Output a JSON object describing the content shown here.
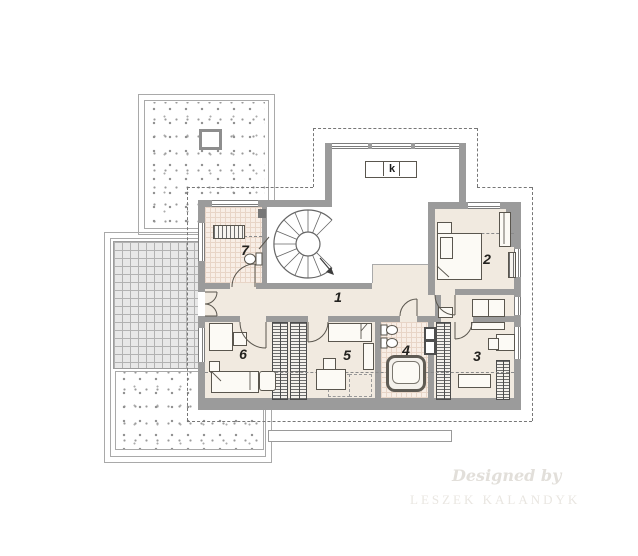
{
  "plan": {
    "title": "Upper floor plan",
    "rooms": [
      {
        "id": "hall",
        "label": "1"
      },
      {
        "id": "bedroom-2",
        "label": "2"
      },
      {
        "id": "bedroom-3",
        "label": "3"
      },
      {
        "id": "bathroom-4",
        "label": "4"
      },
      {
        "id": "bedroom-5",
        "label": "5"
      },
      {
        "id": "bedroom-6",
        "label": "6"
      },
      {
        "id": "bathroom-7",
        "label": "7"
      }
    ],
    "skylight_label": "k",
    "watermark": {
      "line1": "Designed by",
      "line2": "LESZEK KALANDYK"
    },
    "colors": {
      "wall": "#9b9b9b",
      "floor": "#f1eae0",
      "tile_floor": "#f8eee6",
      "terrace": "#e8e8e8",
      "line_dark": "#5a564e",
      "dashed_outline": "#777777",
      "watermark": "#e7e4df"
    }
  }
}
